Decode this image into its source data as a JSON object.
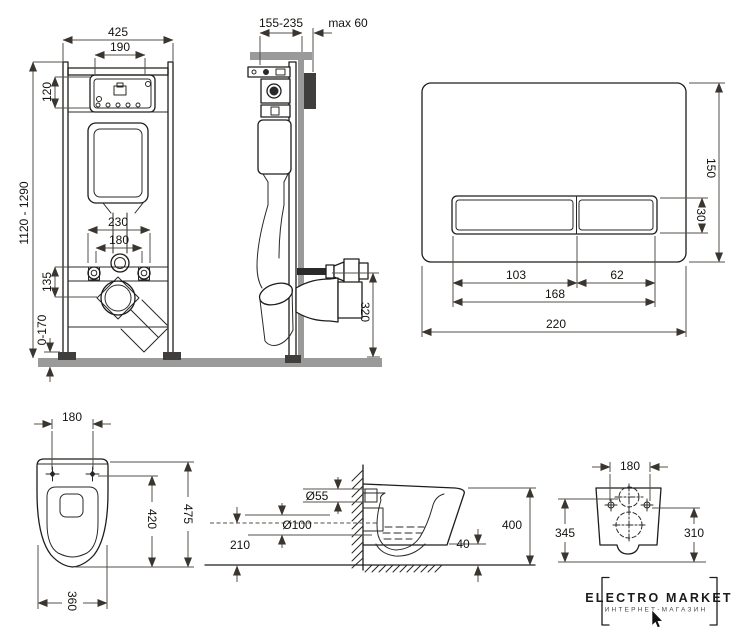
{
  "views": {
    "frame_front": {
      "dim_width": "425",
      "dim_inner_width": "190",
      "dim_panel_height": "120",
      "dim_height_range": "1120 - 1290",
      "dim_bolts_outer": "230",
      "dim_bolts_inner": "180",
      "dim_drain_offset": "135",
      "dim_feet_range": "0-170"
    },
    "frame_side": {
      "dim_depth_range": "155-235",
      "dim_wall_max": "max 60",
      "dim_outlet_height": "320"
    },
    "flush_plate": {
      "dim_height": "150",
      "dim_button_height": "30",
      "dim_button_left": "103",
      "dim_button_right": "62",
      "dim_buttons_total": "168",
      "dim_width": "220"
    },
    "toilet_top": {
      "dim_hole_span": "180",
      "dim_length": "475",
      "dim_inner_length": "420",
      "dim_width": "360"
    },
    "toilet_side": {
      "dim_inlet": "Ø55",
      "dim_outlet": "Ø100",
      "dim_outlet_height": "210",
      "dim_total_height": "400",
      "dim_clearance": "40"
    },
    "toilet_rear": {
      "dim_hole_span": "180",
      "dim_left_height": "345",
      "dim_right_height": "310"
    }
  },
  "logo": {
    "title": "ELECTRO MARKET",
    "subtitle": "ИНТЕРНЕТ-МАГАЗИН"
  },
  "colors": {
    "line": "#1f1d1b",
    "dimension": "#56504a",
    "wall_floor_gray": "#9a9a9a",
    "plate_dark": "#3f3e3d",
    "background": "#ffffff"
  }
}
